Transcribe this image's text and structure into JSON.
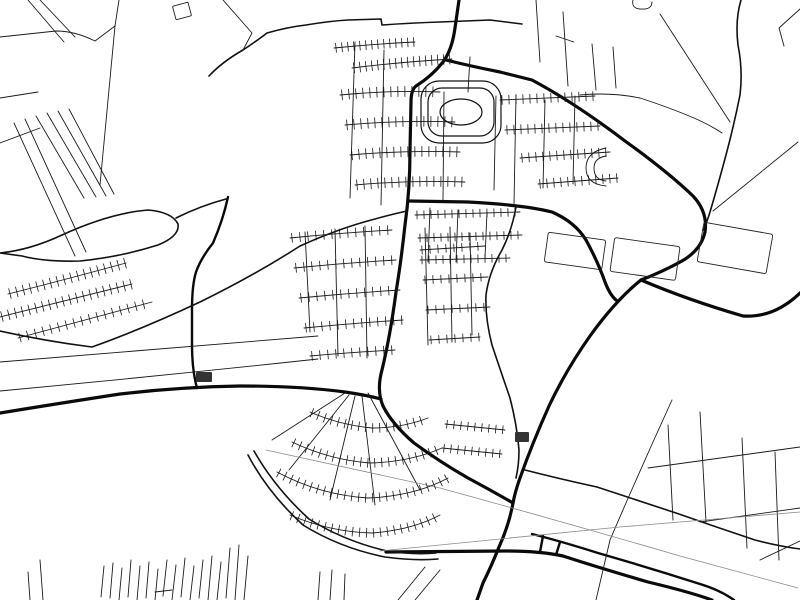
{
  "meta": {
    "type": "street-map-poster",
    "style": "minimal-black-and-white",
    "background_color": "#ffffff",
    "road_color": "#000000",
    "railway_color": "#8a8a8a",
    "canal_color": "#9a9a9a"
  },
  "map": {
    "width": 800,
    "height": 600,
    "layers": [
      {
        "name": "thick-roads",
        "width": 3.2,
        "color": "#0a0a0a",
        "paths": [
          "M459,0 L455,28 Q452,50 443,62 Q432,76 416,86 Q411,90 411,102 L410,150 Q410,190 405,225 Q401,262 396,292 Q390,338 381,374 Q377,392 383,406 Q392,424 414,443 Q440,462 468,478 Q494,492 513,503",
          "M446,60 Q470,66 500,72 L532,80 Q575,103 625,141 Q668,172 693,196 Q708,212 705,232 Q701,250 682,261 Q662,272 641,280",
          "M641,280 Q616,300 590,336 Q566,370 549,406 Q532,444 520,478 Q515,492 513,503",
          "M641,280 Q688,300 743,316 Q774,318 800,293",
          "M409,201 L468,202 Q525,205 552,212 Q575,222 586,240 Q598,262 605,282 Q610,295 616,300",
          "M0,413 Q55,404 120,394 Q180,387 240,386 Q300,386 345,392 Q366,395 381,399",
          "M513,503 Q509,525 499,547 Q491,567 483,583 L477,600",
          "M386,552 L505,551 Q540,551 563,556 Q600,568 648,582 Q690,592 712,600"
        ]
      },
      {
        "name": "semi-thick-roads",
        "width": 2.4,
        "color": "#0a0a0a",
        "paths": [
          "M532,534 Q560,541 598,553 Q650,568 700,584 Q720,590 734,600",
          "M543,536 L540,552",
          "M560,542 L556,555",
          "M228,197 Q223,220 213,243 Q201,258 196,272 Q192,285 192,310 L192,345 Q192,370 197,388"
        ]
      },
      {
        "name": "medium-roads",
        "width": 1.6,
        "color": "#111111",
        "paths": [
          "M0,331 Q45,341 92,347 Q140,330 200,302 Q255,275 300,246 Q340,228 375,219 Q393,214 407,211",
          "M0,253 Q30,250 62,235 Q110,213 148,210 Q172,212 178,224 Q180,236 158,245 Q120,257 80,261 Q45,262 22,256 L0,253",
          "M176,218 Q200,206 226,199",
          "M516,207 Q512,230 502,250 Q489,272 486,295 Q485,318 492,345 Q501,372 510,398 Q517,425 519,450 Q519,465 516,478",
          "M741,0 Q735,20 738,45 Q743,70 740,95 Q734,125 726,155 Q718,185 710,212 Q707,222 703,230",
          "M525,470 Q560,479 597,487 Q637,500 676,513 Q716,527 755,540 Q778,546 800,549",
          "M248,455 Q268,493 303,525 Q340,548 385,557 Q415,561 438,559",
          "M254,451 Q275,488 309,519 Q344,541 387,551 Q414,555 436,553",
          "M209,76 Q222,62 243,50 Q258,40 267,33 Q288,27 306,25 Q330,21 348,20 L381,19 L382,25 Q410,23 440,22 L490,20 L522,24"
        ]
      },
      {
        "name": "thin-roads",
        "width": 0.9,
        "color": "#1a1a1a",
        "paths": [
          "M28,0 L64,42",
          "M40,0 L75,37",
          "M0,37 L56,31 Q75,31 95,41",
          "M95,41 L115,26",
          "M115,26 L100,185",
          "M115,26 L119,0",
          "M223,0 L252,33 L243,50",
          "M14,123 L75,256",
          "M25,119 L86,252",
          "M36,116 L84,198",
          "M47,113 L96,197",
          "M58,111 L106,196",
          "M69,109 L114,194",
          "M0,143 L40,128",
          "M0,98 L38,92",
          "M536,0 L540,62",
          "M563,12 L568,86",
          "M592,44 L596,90",
          "M613,47 L616,88",
          "M580,95 Q610,92 640,98 Q668,107 694,118 Q710,125 722,133",
          "M660,14 L730,122",
          "M798,142 L713,211",
          "M800,9 L779,28 L784,46",
          "M556,36 L574,42",
          "M633,0 Q631,8 640,9 Q652,10 652,2",
          "M0,362 Q160,349 318,336",
          "M0,391 Q160,376 318,359",
          "M425,567 L398,600",
          "M440,570 L415,600",
          "M672,400 Q640,470 610,540 L596,600",
          "M668,425 L673,520",
          "M700,412 L706,522",
          "M742,438 L747,548",
          "M775,452 L779,560",
          "M648,468 Q720,458 800,447",
          "M700,522 Q750,515 800,508",
          "M760,560 L800,541",
          "M40,560 L43,600",
          "M28,572 L30,600",
          "M320,572 L318,600",
          "M332,570 L330,600",
          "M345,574 L344,600",
          "M349,395 L289,470",
          "M355,396 L330,500",
          "M362,396 L375,505",
          "M368,393 L420,490",
          "M345,393 L272,440",
          "M305,232 L310,332",
          "M335,229 L338,356",
          "M365,226 L367,358",
          "M425,228 L428,345",
          "M450,227 L452,342",
          "M470,233 L472,335",
          "M430,208 L428,262",
          "M458,210 L456,262",
          "M487,212 L485,258",
          "M355,42 L350,198",
          "M384,50 L381,205",
          "M444,92 L443,200",
          "M470,57 L468,92",
          "M496,96 L494,190",
          "M516,95 L514,205",
          "M545,100 L543,188",
          "M575,96 L573,184",
          "M606,148 Q586,152 586,168 Q586,184 606,186",
          "M606,156 Q594,158 594,168 Q594,180 606,181",
          "M104,566 L101,597",
          "M113,563 L110,598",
          "M122,568 L119,600",
          "M131,560 L128,597",
          "M140,566 L137,600",
          "M149,562 L146,598",
          "M158,569 L155,600",
          "M167,560 L163,596",
          "M176,565 L172,600",
          "M185,558 L181,597",
          "M194,566 L190,600",
          "M203,560 L199,598",
          "M212,556 L208,600",
          "M221,562 L217,600",
          "M230,548 L226,598",
          "M239,545 L235,600",
          "M248,556 L244,600",
          "M155,592 L172,590"
        ]
      },
      {
        "name": "railway",
        "width": 0.8,
        "color": "#8a8a8a",
        "paths": [
          "M266,450 L440,488 Q560,521 680,556 L798,588",
          "M380,551 L620,527 L800,512"
        ]
      }
    ],
    "combs": [
      {
        "name": "house-row",
        "d": "M334,48 Q375,44 415,42",
        "len": 9,
        "gap": 6,
        "side": "both"
      },
      {
        "name": "house-row",
        "d": "M352,68 Q400,62 452,59",
        "len": 10,
        "gap": 6,
        "side": "both"
      },
      {
        "name": "house-row",
        "d": "M340,95 Q390,90 440,92",
        "len": 10,
        "gap": 7,
        "side": "both"
      },
      {
        "name": "house-row",
        "d": "M345,125 Q400,120 455,122",
        "len": 10,
        "gap": 7,
        "side": "both"
      },
      {
        "name": "house-row",
        "d": "M350,155 Q405,150 460,152",
        "len": 10,
        "gap": 7,
        "side": "both"
      },
      {
        "name": "house-row",
        "d": "M355,185 Q410,180 465,182",
        "len": 10,
        "gap": 7,
        "side": "both"
      },
      {
        "name": "house-row",
        "d": "M500,100 L595,96",
        "len": 9,
        "gap": 7,
        "side": "both"
      },
      {
        "name": "house-row",
        "d": "M505,130 L600,126",
        "len": 9,
        "gap": 7,
        "side": "both"
      },
      {
        "name": "house-row",
        "d": "M520,158 L610,152",
        "len": 9,
        "gap": 7,
        "side": "both"
      },
      {
        "name": "house-row",
        "d": "M538,184 L618,178",
        "len": 9,
        "gap": 7,
        "side": "both"
      },
      {
        "name": "house-row",
        "d": "M415,215 L520,212",
        "len": 8,
        "gap": 7,
        "side": "both"
      },
      {
        "name": "house-row",
        "d": "M418,238 L522,235",
        "len": 8,
        "gap": 7,
        "side": "both"
      },
      {
        "name": "house-row",
        "d": "M420,260 L510,258",
        "len": 8,
        "gap": 7,
        "side": "both"
      },
      {
        "name": "house-row",
        "d": "M290,238 Q340,233 392,230",
        "len": 9,
        "gap": 8,
        "side": "both"
      },
      {
        "name": "house-row",
        "d": "M294,268 Q345,263 396,260",
        "len": 9,
        "gap": 8,
        "side": "both"
      },
      {
        "name": "house-row",
        "d": "M299,298 Q350,293 400,290",
        "len": 9,
        "gap": 8,
        "side": "both"
      },
      {
        "name": "house-row",
        "d": "M304,328 Q355,323 403,320",
        "len": 9,
        "gap": 8,
        "side": "both"
      },
      {
        "name": "house-row",
        "d": "M310,356 Q355,352 395,350",
        "len": 9,
        "gap": 8,
        "side": "both"
      },
      {
        "name": "house-row",
        "d": "M420,250 L485,246",
        "len": 8,
        "gap": 8,
        "side": "both"
      },
      {
        "name": "house-row",
        "d": "M423,280 L488,277",
        "len": 8,
        "gap": 8,
        "side": "both"
      },
      {
        "name": "house-row",
        "d": "M426,310 L490,307",
        "len": 8,
        "gap": 8,
        "side": "both"
      },
      {
        "name": "house-row",
        "d": "M429,340 L480,337",
        "len": 8,
        "gap": 8,
        "side": "both"
      },
      {
        "name": "house-row",
        "d": "M8,294 Q60,281 126,263",
        "len": 10,
        "gap": 7,
        "side": "both"
      },
      {
        "name": "house-row",
        "d": "M0,317 Q65,301 132,284",
        "len": 10,
        "gap": 7,
        "side": "both"
      },
      {
        "name": "house-row",
        "d": "M18,338 Q85,320 152,302",
        "len": 9,
        "gap": 8,
        "side": "both"
      },
      {
        "name": "house-row",
        "d": "M310,412 Q340,425 372,428 Q402,428 428,418",
        "len": 9,
        "gap": 7,
        "side": "both"
      },
      {
        "name": "house-row",
        "d": "M292,442 Q330,460 370,463 Q410,462 442,448",
        "len": 9,
        "gap": 7,
        "side": "both"
      },
      {
        "name": "house-row",
        "d": "M277,472 Q320,495 368,498 Q415,496 448,478",
        "len": 9,
        "gap": 7,
        "side": "both"
      },
      {
        "name": "house-row",
        "d": "M290,515 Q330,532 372,533 Q412,530 440,515",
        "len": 9,
        "gap": 7,
        "side": "both"
      },
      {
        "name": "house-row",
        "d": "M445,424 L505,430",
        "len": 8,
        "gap": 7,
        "side": "both"
      },
      {
        "name": "house-row",
        "d": "M442,448 L502,454",
        "len": 8,
        "gap": 7,
        "side": "both"
      }
    ],
    "shapes": [
      {
        "type": "rrect",
        "name": "stadium-outer-ring",
        "x": 421,
        "y": 81,
        "w": 80,
        "h": 62,
        "rx": 18,
        "stroke": "#111",
        "sw": 1.2
      },
      {
        "type": "rrect",
        "name": "stadium-block",
        "x": 428,
        "y": 88,
        "w": 66,
        "h": 48,
        "rx": 14,
        "stroke": "#111",
        "sw": 1.2
      },
      {
        "type": "ellipse",
        "name": "stadium-oval",
        "cx": 461,
        "cy": 112,
        "rx": 21,
        "ry": 13,
        "stroke": "#111",
        "sw": 1.2
      },
      {
        "type": "rrect",
        "name": "field-parcel",
        "x": 546,
        "y": 236,
        "w": 58,
        "h": 30,
        "rx": 2,
        "rot": 8,
        "stroke": "#222",
        "sw": 0.9
      },
      {
        "type": "rrect",
        "name": "field-parcel",
        "x": 612,
        "y": 242,
        "w": 66,
        "h": 34,
        "rx": 2,
        "rot": 8,
        "stroke": "#222",
        "sw": 0.9
      },
      {
        "type": "rrect",
        "name": "field-parcel",
        "x": 700,
        "y": 228,
        "w": 70,
        "h": 40,
        "rx": 2,
        "rot": 10,
        "stroke": "#222",
        "sw": 0.9
      },
      {
        "type": "rrect",
        "name": "small-square-parcel",
        "x": 174,
        "y": 4,
        "w": 16,
        "h": 14,
        "rx": 1,
        "rot": -15,
        "stroke": "#222",
        "sw": 0.9
      },
      {
        "type": "rrect",
        "name": "building-block",
        "x": 196,
        "y": 372,
        "w": 16,
        "h": 10,
        "rx": 1,
        "fill": "#333"
      },
      {
        "type": "rrect",
        "name": "building-block",
        "x": 515,
        "y": 432,
        "w": 14,
        "h": 10,
        "rx": 1,
        "fill": "#333"
      }
    ]
  }
}
